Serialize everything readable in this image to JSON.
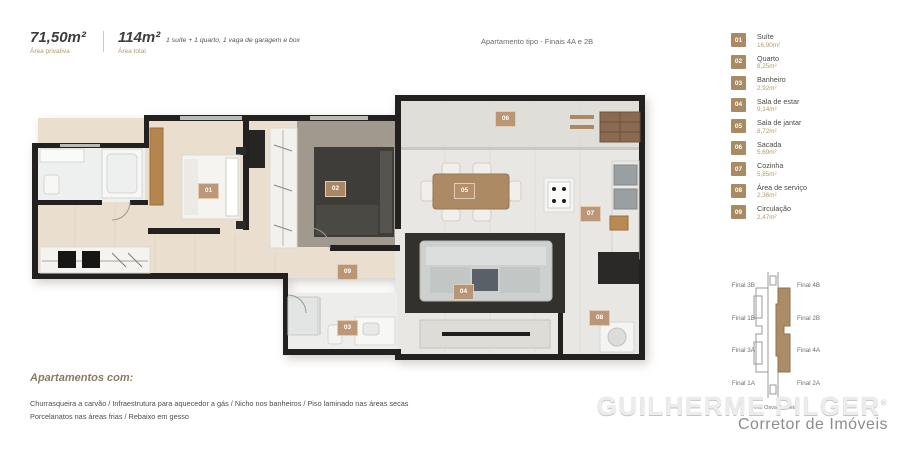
{
  "header": {
    "area_private": {
      "value": "71,50m²",
      "label": "Área privativa"
    },
    "area_total": {
      "value": "114m²",
      "label": "Área total"
    },
    "description": "1 suíte + 1 quarto, 1 vaga de garagem e box",
    "plan_title": "Apartamento tipo - Finais 4A e 2B"
  },
  "legend": {
    "items": [
      {
        "num": "01",
        "label": "Suíte",
        "area": "16,90m²"
      },
      {
        "num": "02",
        "label": "Quarto",
        "area": "8,25m²"
      },
      {
        "num": "03",
        "label": "Banheiro",
        "area": "2,92m²"
      },
      {
        "num": "04",
        "label": "Sala de estar",
        "area": "9,14m²"
      },
      {
        "num": "05",
        "label": "Sala de jantar",
        "area": "8,72m²"
      },
      {
        "num": "06",
        "label": "Sacada",
        "area": "5,69m²"
      },
      {
        "num": "07",
        "label": "Cozinha",
        "area": "5,85m²"
      },
      {
        "num": "08",
        "label": "Área de serviço",
        "area": "2,36m²"
      },
      {
        "num": "09",
        "label": "Circulação",
        "area": "2,47m²"
      }
    ]
  },
  "key_plan": {
    "labels_left": [
      "Final 3B",
      "Final 1B",
      "Final 3A",
      "Final 1A"
    ],
    "labels_right": [
      "Final 4B",
      "Final 2B",
      "Final 4A",
      "Final 2A"
    ],
    "highlighted_units": [
      "Final 2B",
      "Final 4A"
    ],
    "caption": "Av. Osvaldo Reis"
  },
  "floorplan": {
    "badges": [
      "01",
      "02",
      "03",
      "04",
      "05",
      "06",
      "07",
      "08",
      "09"
    ]
  },
  "footer": {
    "heading": "Apartamentos com:",
    "line1": "Churrasqueira a carvão / Infraestrutura para aquecedor a gás / Nicho nos banheiros / Piso laminado nas áreas secas",
    "line2": "Porcelanatos nas áreas frias / Rebaixo em gesso"
  },
  "watermark": {
    "name": "GUILHERME PILGER",
    "registered": "®",
    "subtitle": "Corretor de Imóveis"
  },
  "colors": {
    "accent_tan": "#a98a62",
    "wall": "#22211f",
    "wood_floor": "#eadfce",
    "tile_floor": "#e8e7e3",
    "highlight_unit": "#ac8c66"
  }
}
